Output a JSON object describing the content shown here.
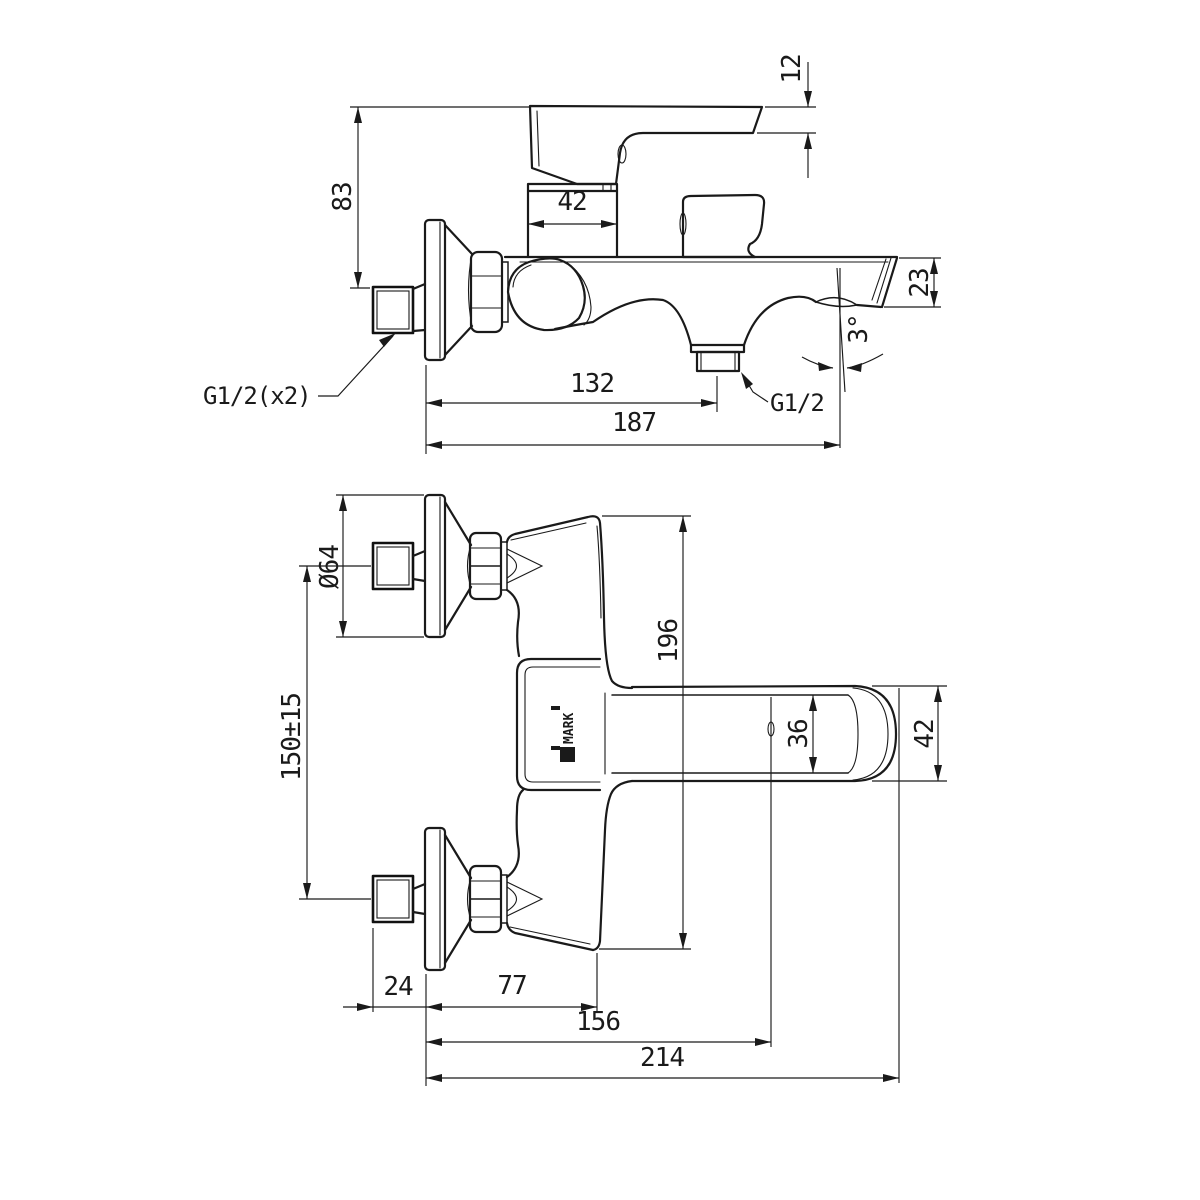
{
  "page": {
    "background": "#ffffff",
    "line_color": "#1a1a1a"
  },
  "drawing": {
    "side_view": {
      "dim_handle_thickness": "12",
      "dim_handle_height": "83",
      "dim_body_width": "42",
      "dim_spout_end_height": "23",
      "spout_angle": "3°",
      "dim_wall_to_shower_outlet": "132",
      "dim_wall_to_spout_tip": "187",
      "label_inlet_thread": "G1/2(x2)",
      "label_shower_outlet_thread": "G1/2"
    },
    "front_view": {
      "dim_escutcheon_diameter": "Ø64",
      "dim_inlet_spacing": "150±15",
      "dim_body_length": "196",
      "dim_handle_width": "36",
      "dim_handle_end_width": "42",
      "dim_inlet_offset": "24",
      "dim_wall_to_body_end": "77",
      "dim_wall_to_spout": "156",
      "dim_overall_length": "214",
      "brand_mark": "L",
      "brand_name": "MARK"
    }
  }
}
